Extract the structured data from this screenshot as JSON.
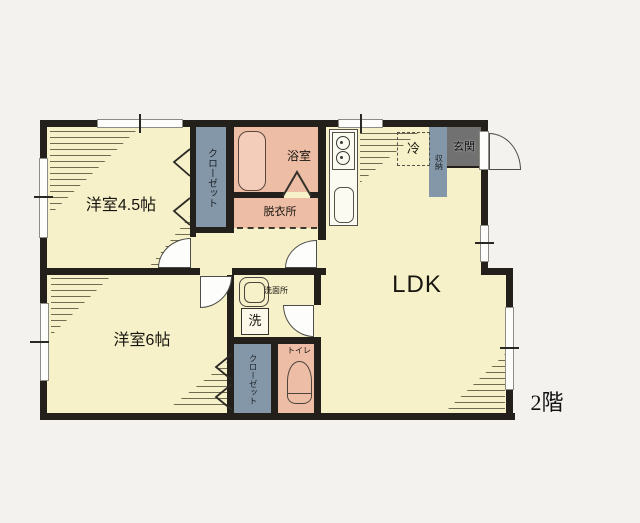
{
  "floor_badge": "2階",
  "rooms": {
    "room45": {
      "label": "洋室4.5帖"
    },
    "room6": {
      "label": "洋室6帖"
    },
    "ldk": {
      "label": "LDK"
    },
    "bathroom": {
      "label": "浴室"
    },
    "dressing": {
      "label": "脱衣所"
    },
    "washroom": {
      "label": "洗面所"
    },
    "toilet": {
      "label": "トイレ"
    },
    "entrance": {
      "label": "玄関"
    },
    "closet_a": {
      "label": "クローゼット"
    },
    "closet_b": {
      "label": "クローゼット"
    },
    "storage": {
      "label": "収納"
    }
  },
  "fixtures": {
    "refrigerator": {
      "label": "冷"
    },
    "washing_machine": {
      "label": "洗"
    }
  },
  "colors": {
    "room_floor": "#f7f1c9",
    "wet_area": "#edbda6",
    "bathtub": "#f3cdba",
    "closet": "#8497a8",
    "entrance_floor": "#717171",
    "wall": "#23201c",
    "background": "#f3f2ef"
  }
}
